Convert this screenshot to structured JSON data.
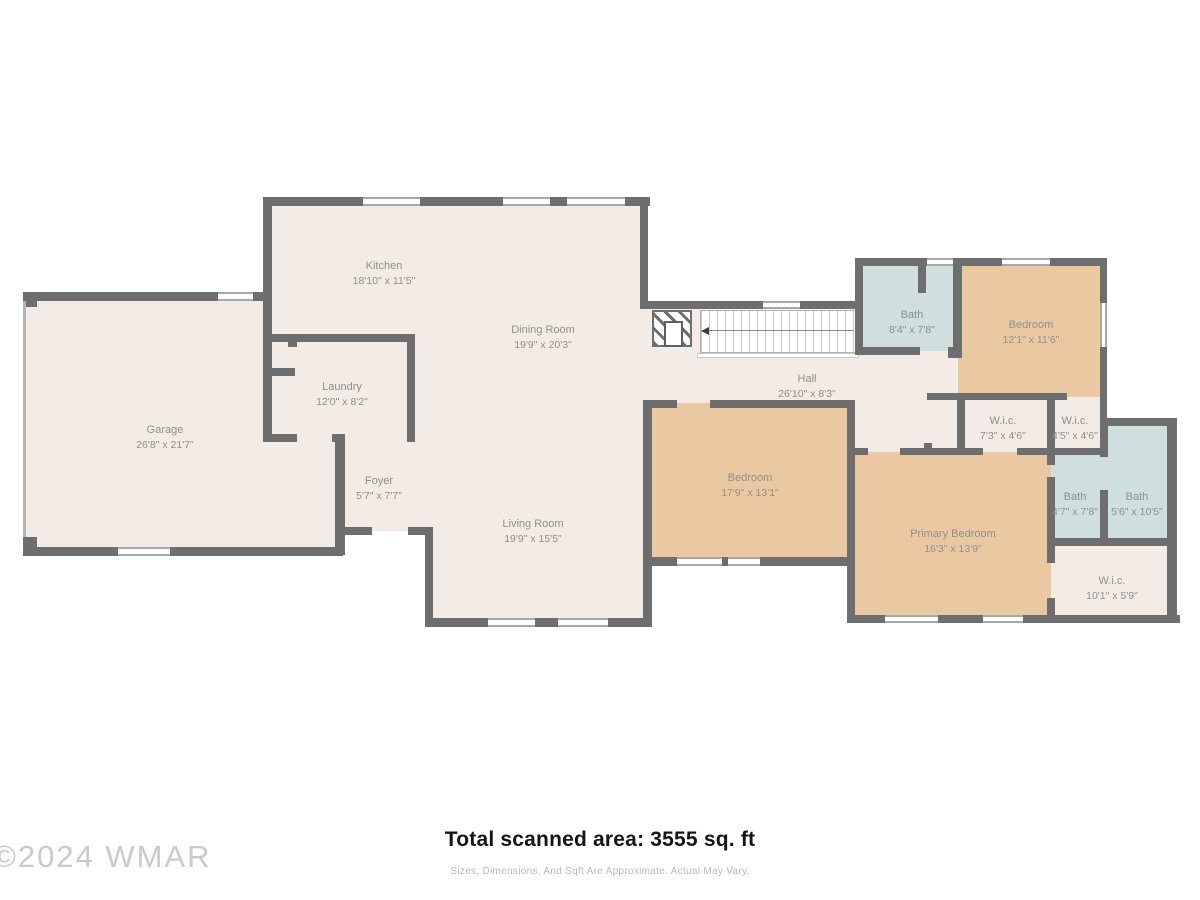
{
  "watermark": "©2024 WMAR",
  "footer": {
    "total_area": "Total scanned area: 3555 sq. ft",
    "disclaimer": "Sizes, Dimensions, And Sqft Are Approximate. Actual May Vary."
  },
  "colors": {
    "wall": "#6e6e6e",
    "room_beige": "#f3ece6",
    "room_tan": "#eac9a2",
    "room_blue": "#cfdfdf",
    "label_text": "#8f8f8c"
  },
  "rooms": [
    {
      "label": "Garage",
      "dims": "26'8\" x 21'7\""
    },
    {
      "label": "Kitchen",
      "dims": "18'10\" x 11'5\""
    },
    {
      "label": "Dining Room",
      "dims": "19'9\" x 20'3\""
    },
    {
      "label": "Laundry",
      "dims": "12'0\" x 8'2\""
    },
    {
      "label": "Foyer",
      "dims": "5'7\" x 7'7\""
    },
    {
      "label": "Living Room",
      "dims": "19'9\" x 15'5\""
    },
    {
      "label": "Hall",
      "dims": "26'10\" x 8'3\""
    },
    {
      "label": "Bath",
      "dims": "8'4\" x 7'8\""
    },
    {
      "label": "Bedroom",
      "dims": "12'1\" x 11'6\""
    },
    {
      "label": "W.i.c.",
      "dims": "7'3\" x 4'6\""
    },
    {
      "label": "W.i.c.",
      "dims": "4'5\" x 4'6\""
    },
    {
      "label": "Bedroom",
      "dims": "17'9\" x 13'1\""
    },
    {
      "label": "Primary Bedroom",
      "dims": "16'3\" x 13'9\""
    },
    {
      "label": "Bath",
      "dims": "4'7\" x 7'8\""
    },
    {
      "label": "Bath",
      "dims": "5'6\" x 10'5\""
    },
    {
      "label": "W.i.c.",
      "dims": "10'1\" x 5'9\""
    }
  ]
}
